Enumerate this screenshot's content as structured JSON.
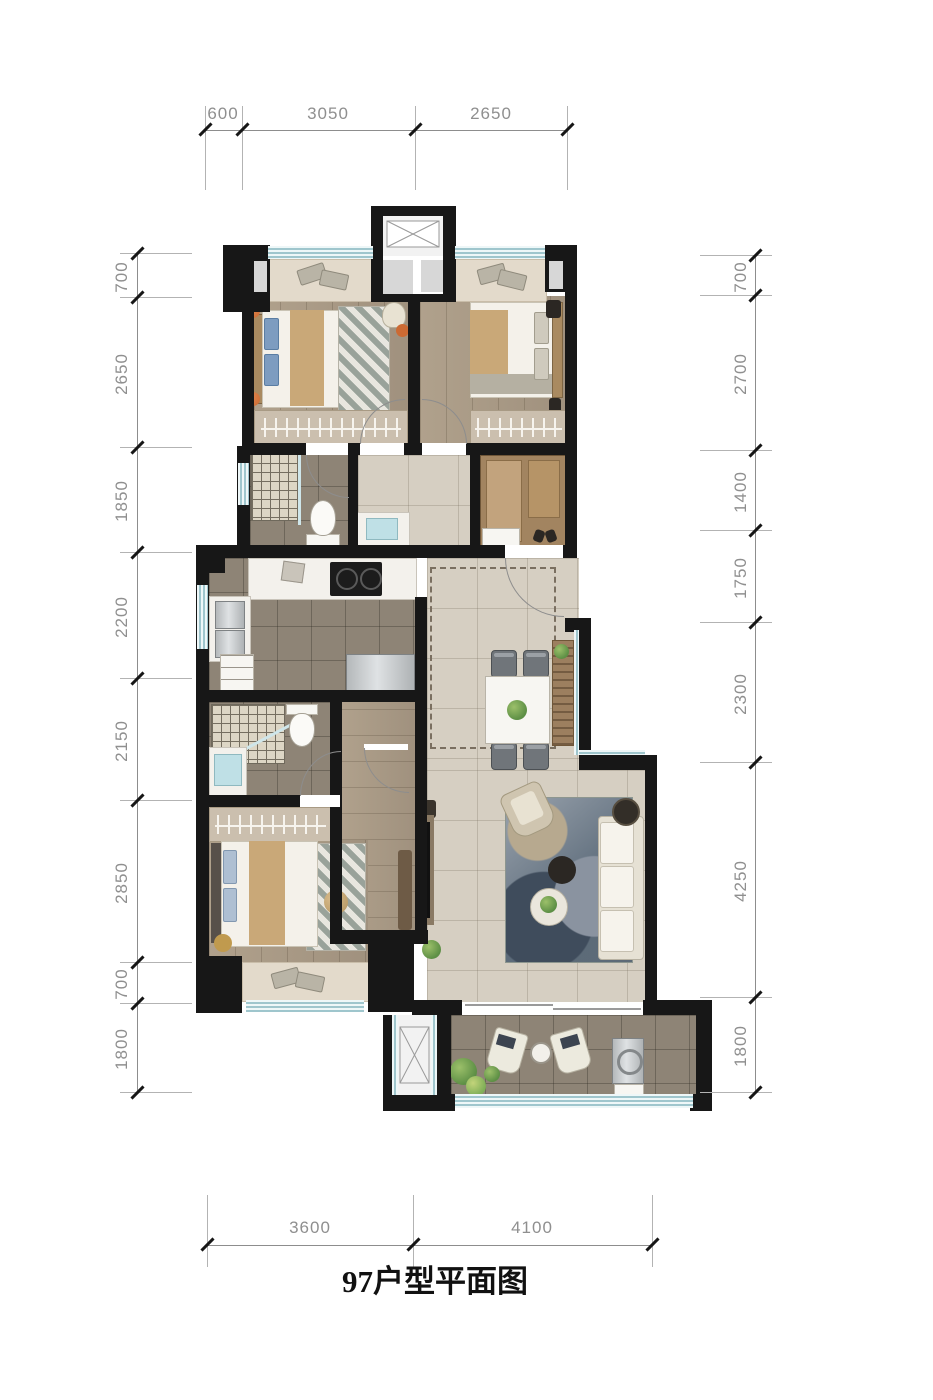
{
  "title": "97户型平面图",
  "dimensions": {
    "top": [
      "600",
      "3050",
      "2650"
    ],
    "bottom": [
      "3600",
      "4100"
    ],
    "left": [
      "700",
      "2650",
      "1850",
      "2200",
      "2150",
      "2850",
      "700",
      "1800"
    ],
    "right": [
      "700",
      "2700",
      "1400",
      "1750",
      "2300",
      "4250",
      "1800"
    ]
  },
  "palette": {
    "wall": "#171717",
    "column_fill": "#d7d7d7",
    "window_glass": "#c2dde2",
    "wood_floor": "#a89a86",
    "light_tile": "#d6cfc2",
    "dark_tile": "#8e8476",
    "dimension_text": "#8f8f8f",
    "bed_throw_tan": "#c9a878",
    "sofa_white": "#efece3",
    "rug_blue": "#5c6b7a",
    "plant_green": "#6f9c4f",
    "accent_orange": "#cc6a33"
  }
}
